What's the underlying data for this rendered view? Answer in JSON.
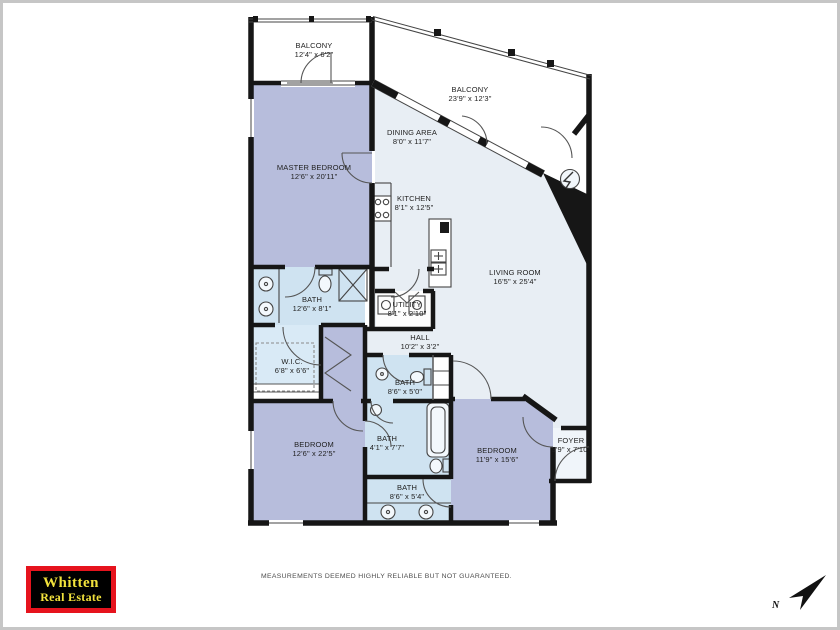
{
  "rooms": [
    {
      "id": "balcony-top-left",
      "name": "BALCONY",
      "dims": "12'4\" x 6'2\""
    },
    {
      "id": "balcony-top-right",
      "name": "BALCONY",
      "dims": "23'9\" x 12'3\""
    },
    {
      "id": "master-bedroom",
      "name": "MASTER BEDROOM",
      "dims": "12'6\" x 20'11\""
    },
    {
      "id": "dining-area",
      "name": "DINING AREA",
      "dims": "8'0\" x 11'7\""
    },
    {
      "id": "kitchen",
      "name": "KITCHEN",
      "dims": "8'1\" x 12'5\""
    },
    {
      "id": "living-room",
      "name": "LIVING ROOM",
      "dims": "16'5\" x 25'4\""
    },
    {
      "id": "master-bath",
      "name": "BATH",
      "dims": "12'6\" x 8'1\""
    },
    {
      "id": "utility",
      "name": "UTILITY",
      "dims": "8'1\" x 2'10\""
    },
    {
      "id": "hall",
      "name": "HALL",
      "dims": "10'2\" x 3'2\""
    },
    {
      "id": "walk-in-closet",
      "name": "W.I.C.",
      "dims": "6'8\" x 6'6\""
    },
    {
      "id": "bath-2",
      "name": "BATH",
      "dims": "8'6\" x 5'0\""
    },
    {
      "id": "bath-3",
      "name": "BATH",
      "dims": "4'1\" x 7'7\""
    },
    {
      "id": "bath-4",
      "name": "BATH",
      "dims": "8'6\" x 5'4\""
    },
    {
      "id": "bedroom-left",
      "name": "BEDROOM",
      "dims": "12'6\" x 22'5\""
    },
    {
      "id": "bedroom-right",
      "name": "BEDROOM",
      "dims": "11'9\" x 15'6\""
    },
    {
      "id": "foyer",
      "name": "FOYER",
      "dims": "3'9\" x 7'10\""
    }
  ],
  "footer": {
    "disclaimer": "MEASUREMENTS DEEMED HIGHLY RELIABLE BUT NOT GUARANTEED."
  },
  "logo": {
    "line1": "Whitten",
    "line2": "Real Estate"
  },
  "compass": {
    "label": "N",
    "icon": "north-arrow"
  },
  "colors": {
    "wall": "#161616",
    "bedroom_fill": "#b7bddc",
    "living_fill": "#e8eef4",
    "bath_fill": "#cfe3f1",
    "wic_fill": "#d9eaf6",
    "foyer_fill": "#f0f5fa",
    "logo_red": "#e6131d",
    "logo_yellow": "#f2e23c",
    "page_border": "#c6c6c6"
  }
}
